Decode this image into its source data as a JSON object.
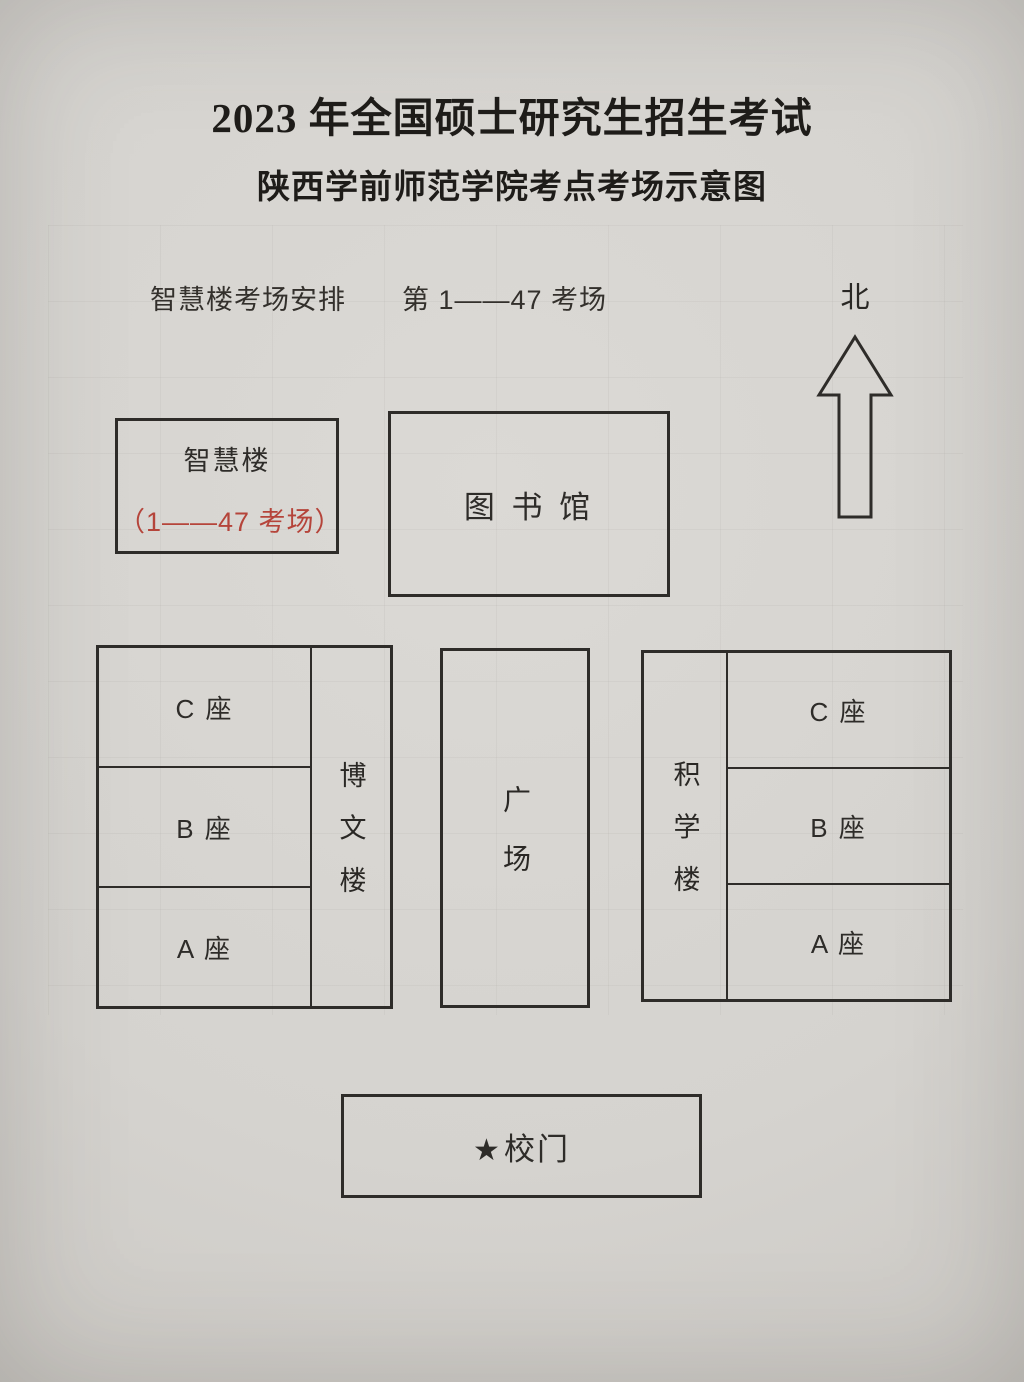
{
  "page": {
    "title": "2023 年全国硕士研究生招生考试",
    "subtitle": "陕西学前师范学院考点考场示意图",
    "note_building": "智慧楼考场安排",
    "note_rooms": "第 1——47 考场",
    "compass": {
      "label": "北",
      "icon": "north-up-arrow"
    }
  },
  "colors": {
    "accent_red": "#b5443a",
    "ink": "#2e2c29",
    "paper": "#d6d4d0"
  },
  "buildings": {
    "zhihui": {
      "name": "智慧楼",
      "rooms": "（1——47 考场）"
    },
    "library": {
      "name": "图 书 馆"
    },
    "bowen": {
      "name": "博文楼",
      "sections": [
        "C 座",
        "B 座",
        "A 座"
      ]
    },
    "plaza": {
      "name": "广场"
    },
    "jixue": {
      "name": "积学楼",
      "sections": [
        "C 座",
        "B 座",
        "A 座"
      ]
    },
    "gate": {
      "star": "★",
      "name": "校门"
    }
  }
}
